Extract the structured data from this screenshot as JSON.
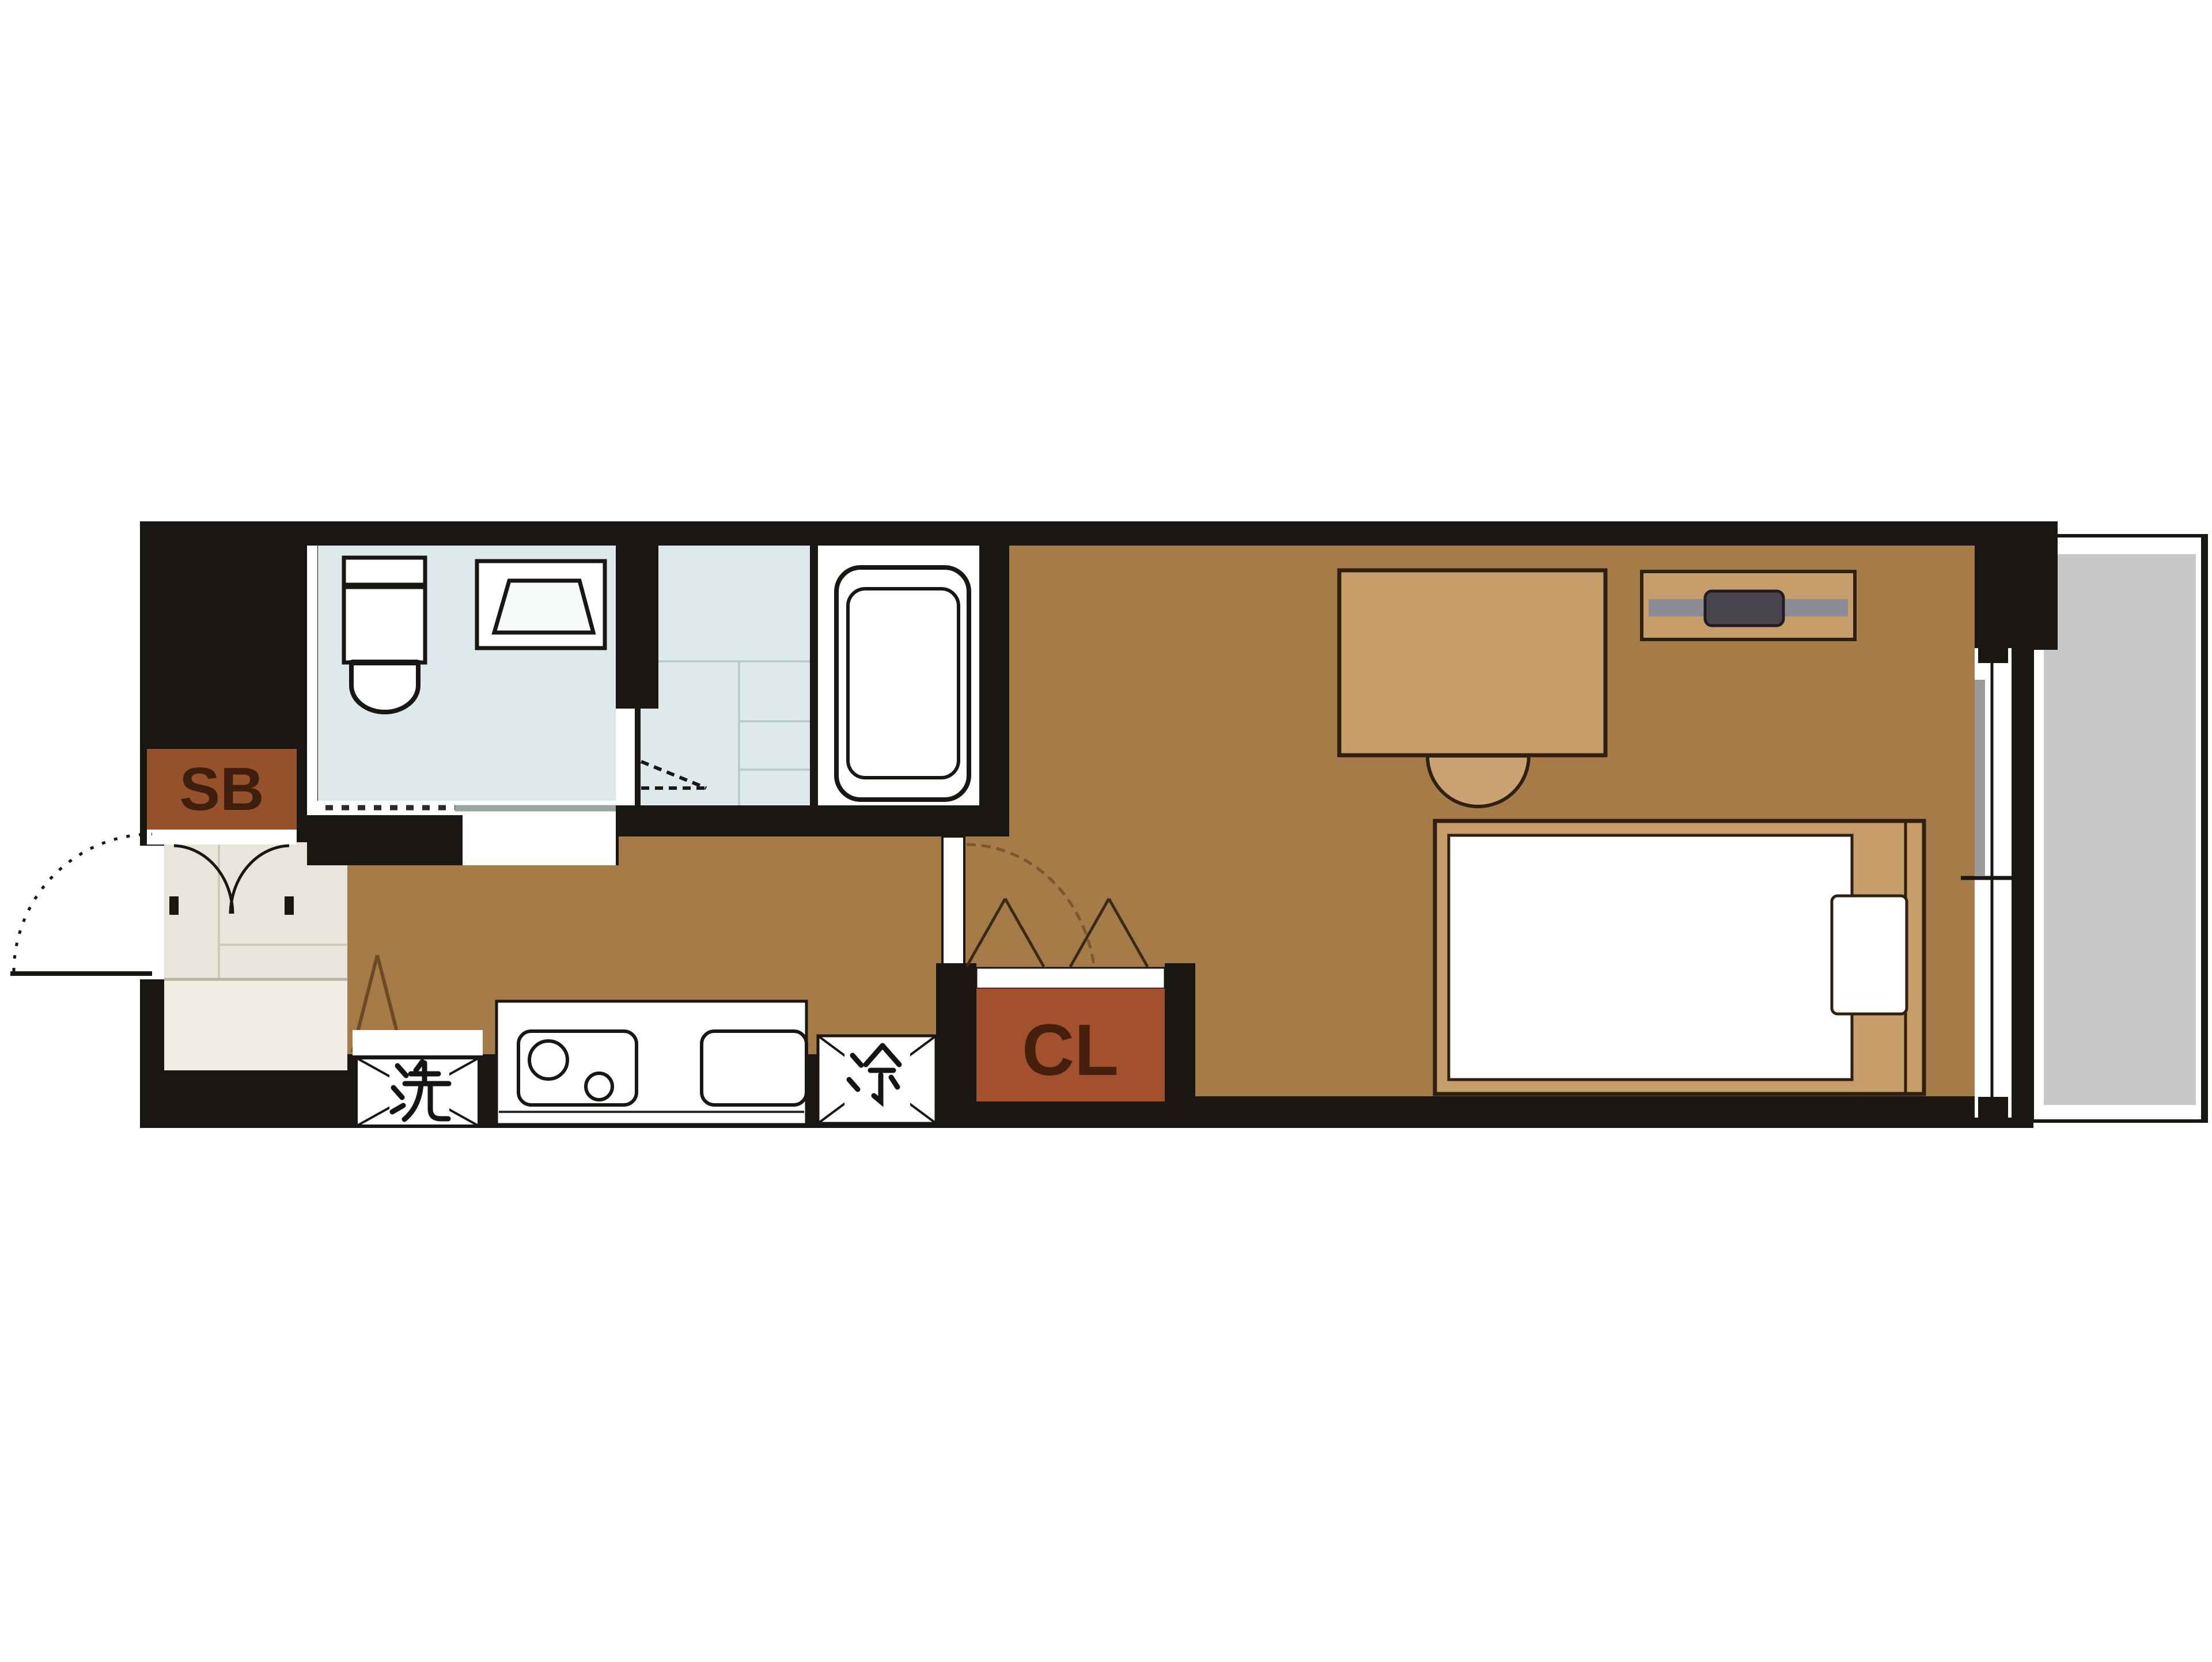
{
  "plan": {
    "type": "apartment-floor-plan",
    "labels": {
      "shoe_box": "SB",
      "closet": "CL",
      "washing_machine": "洗",
      "refrigerator": "冷"
    },
    "colors": {
      "wall": "#1a1612",
      "floor_main_room": "#a57c48",
      "floor_entry": "#e9e5db",
      "floor_entry_step": "#f0ece4",
      "floor_wet_room": "#dde9eb",
      "floor_bath": "#ffffff",
      "balcony_gray": "#c8c8c8",
      "furniture_tan": "#c79e6a",
      "shoe_box_bg": "#96522b",
      "shoe_box_text": "#3f1f0d",
      "closet_bg": "#a3512d",
      "closet_text": "#44200d",
      "tv_shelf_bar": "#8b8b94",
      "tv_body": "#49454e",
      "door_arc_brown": "#7a5731"
    }
  }
}
